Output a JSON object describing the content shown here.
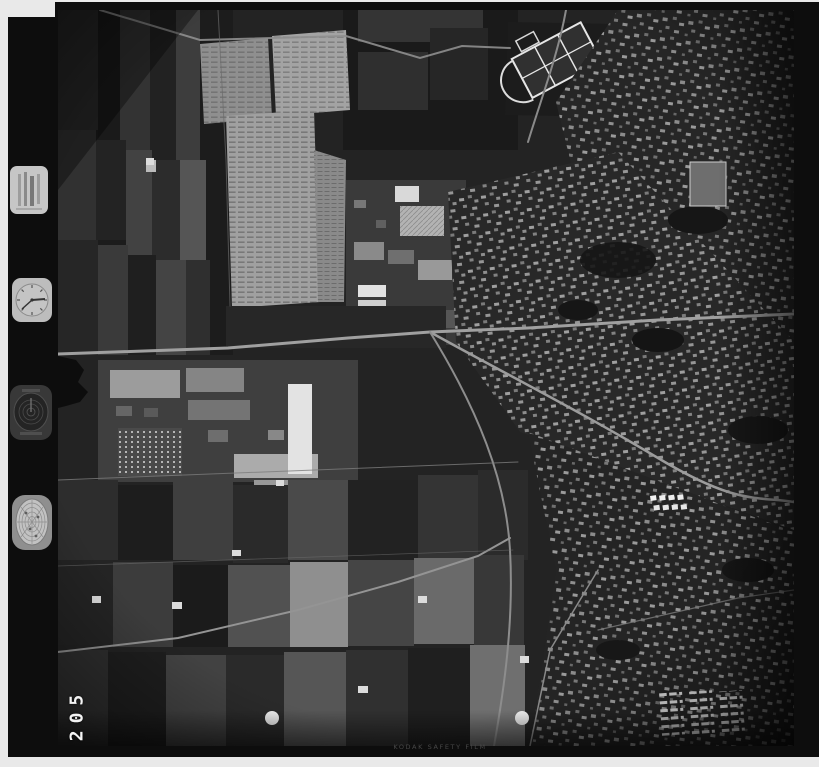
{
  "page": {
    "title": "Vertical aerial photograph contact print, black-and-white film frame"
  },
  "film": {
    "frame_number": "205",
    "caption": "KODAK SAFETY FILM",
    "colors": {
      "paper": "#e9e9e9",
      "film_base": "#0d0d0d",
      "photo_base": "#1f1f1f",
      "highlight": "#f2f2f2"
    }
  },
  "instruments": {
    "data_plate": "data-plate",
    "clock": "clock-dial",
    "altimeter": "altimeter-dial",
    "level_gauge": "level-gauge-dial"
  },
  "scene": {
    "features": [
      "farm-field-patchwork",
      "nursery-rows",
      "industrial-yards",
      "town-housing",
      "water-treatment-plant",
      "stadium-running-track",
      "roads",
      "farmsteads",
      "registration-punch-dots"
    ]
  }
}
